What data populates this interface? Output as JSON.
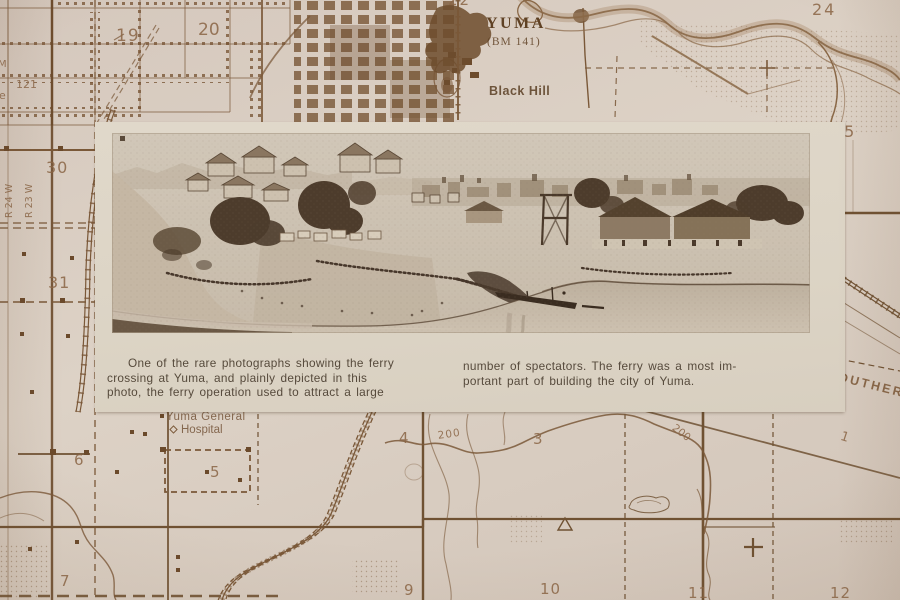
{
  "photo_card": {
    "caption_left_lines": [
      "One of the rare photographs showing the ferry",
      "crossing at Yuma, and plainly depicted in this",
      "photo, the ferry operation used to attract a large"
    ],
    "caption_right_lines": [
      "number of spectators. The ferry was a most im-",
      "portant part of building the city of Yuma."
    ]
  },
  "map": {
    "title_label": "YUMA",
    "benchmark_label": "(BM 141)",
    "hill_label": "Black Hill",
    "hospital_label_line1": "Yuma General",
    "hospital_label_line2": "Hospital",
    "railroad_label": "OUTHERN",
    "range_label_west": "R 24 W",
    "range_label_east": "R 23 W",
    "road_number": "121",
    "edge_fragment_m": "M",
    "edge_fragment_e": "e",
    "contour_label_a": "200",
    "contour_label_b": "200",
    "section_numbers": {
      "s19": "19",
      "s20": "20",
      "s22": "22",
      "s24": "24",
      "s25": "25",
      "s30": "30",
      "s31": "31",
      "s1": "1",
      "s3": "3",
      "s4": "4",
      "s5": "5",
      "s6": "6",
      "s7": "7",
      "s9": "9",
      "s10": "10",
      "s11": "11",
      "s12": "12"
    }
  },
  "colors": {
    "map_ink": "#7a5838",
    "map_paper": "#d8ccc1",
    "card_paper": "#ddd4c6",
    "caption_ink": "#564a3c",
    "photo_dark": "#4d3c2c",
    "photo_light": "#cdc2b2"
  }
}
